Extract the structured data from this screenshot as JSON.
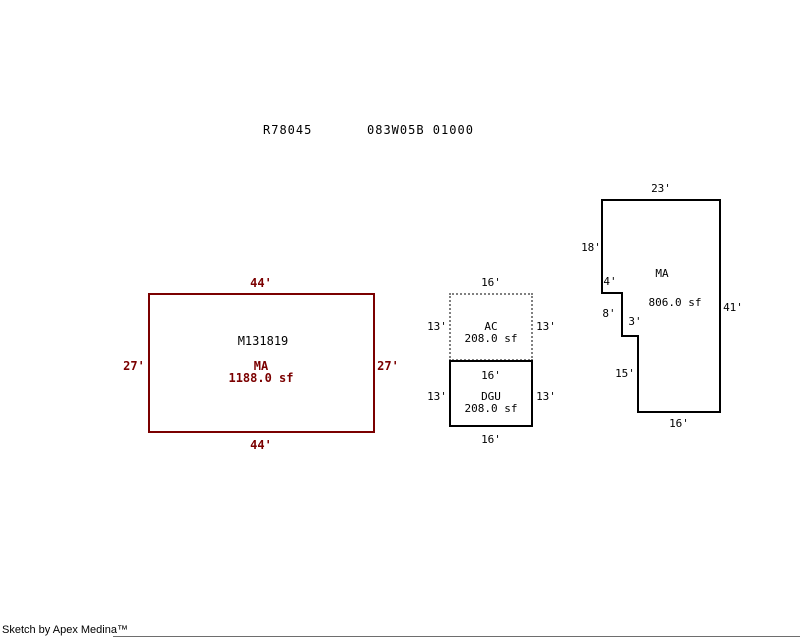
{
  "header": {
    "account": "R78045",
    "parcel": "083W05B 01000"
  },
  "shapes": {
    "main_left": {
      "id_label": "M131819",
      "code": "MA",
      "area": "1188.0 sf",
      "dims": {
        "top": "44'",
        "bottom": "44'",
        "left": "27'",
        "right": "27'"
      }
    },
    "ac": {
      "code": "AC",
      "area": "208.0 sf",
      "dims": {
        "top": "16'",
        "left": "13'",
        "right": "13'"
      }
    },
    "dgu": {
      "code": "DGU",
      "area": "208.0 sf",
      "dims": {
        "top": "16'",
        "left": "13'",
        "right": "13'",
        "bottom": "16'"
      }
    },
    "main_right": {
      "code": "MA",
      "area": "806.0 sf",
      "dims": {
        "top": "23'",
        "left_upper": "18'",
        "notch_in": "4'",
        "notch_down": "8'",
        "notch_in2": "3'",
        "left_lower": "15'",
        "bottom": "16'",
        "right": "41'"
      }
    }
  },
  "footer": {
    "credit": "Sketch by Apex Medina™"
  },
  "colors": {
    "main_area_outline": "#7b0000",
    "accessory_outline": "#000000",
    "dotted_outline": "#808080"
  }
}
